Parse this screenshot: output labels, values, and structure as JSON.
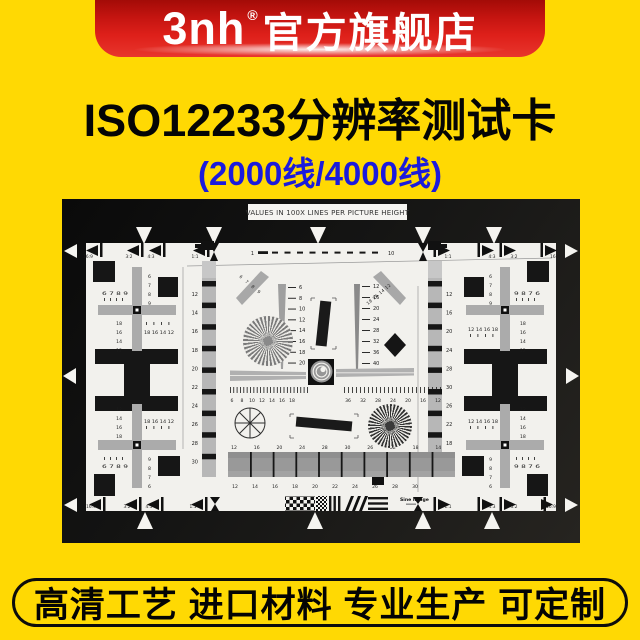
{
  "header": {
    "brand": "3nh",
    "registered": "®",
    "store": "官方旗舰店"
  },
  "title": "ISO12233分辨率测试卡",
  "subtitle": "(2000线/4000线)",
  "footer": "高清工艺 进口材料 专业生产 可定制",
  "colors": {
    "background_yellow": "#FFD903",
    "banner_red": "#DE201A",
    "subtitle_blue": "#1B1BDC",
    "chart_board_black": "#141414",
    "chart_paper_white": "#F2F1ED"
  },
  "chart": {
    "heading": "VALUES IN 100X LINES PER PICTURE HEIGHT",
    "maker": "Sine Image",
    "ruler_start": "1",
    "ruler_end": "10",
    "aspect_top_left": [
      "16:9",
      "3:2",
      "4:3",
      "1:1"
    ],
    "aspect_top_right": [
      "1:1",
      "4:3",
      "3:2",
      "16:9"
    ],
    "aspect_bottom_left": [
      "16:9",
      "3:2",
      "4:3",
      "1:1"
    ],
    "aspect_bottom_right": [
      "1:1",
      "4:3",
      "3:2",
      "16:9"
    ],
    "left_strip": [
      12,
      14,
      16,
      18,
      20,
      22,
      24,
      26,
      28,
      30
    ],
    "right_strip": [
      12,
      16,
      20,
      24,
      28,
      30,
      26,
      22,
      18,
      14
    ],
    "wedge_left": [
      6,
      8,
      10,
      12,
      14,
      16,
      18,
      20
    ],
    "wedge_right": [
      12,
      16,
      20,
      24,
      28,
      32,
      36,
      40
    ],
    "ruler_left": [
      6,
      8,
      10,
      12,
      14,
      16,
      18
    ],
    "ruler_right": [
      36,
      32,
      28,
      24,
      20,
      16,
      12
    ],
    "steps_top": [
      12,
      16,
      20,
      24,
      28,
      30,
      26,
      22,
      18,
      14
    ],
    "steps_bottom": [
      12,
      14,
      16,
      18,
      20,
      22,
      24,
      26,
      28,
      30
    ],
    "diag_left": [
      6,
      7,
      8,
      9
    ],
    "diag_right": [
      18,
      16,
      14,
      12
    ],
    "corner_tl": {
      "row": [
        6,
        7,
        8,
        9
      ],
      "stack": [
        6,
        7,
        8,
        9
      ],
      "beam_stack": [
        18,
        16,
        14,
        12
      ],
      "beam_row": [
        18,
        16,
        14,
        12
      ]
    },
    "corner_tr": {
      "row": [
        9,
        8,
        7,
        6
      ],
      "stack": [
        6,
        7,
        8,
        9
      ],
      "beam_stack": [
        18,
        16,
        14,
        12
      ],
      "beam_row": [
        12,
        14,
        16,
        18
      ]
    },
    "corner_bl": {
      "row": [
        6,
        7,
        8,
        9
      ],
      "stack": [
        9,
        8,
        7,
        6
      ],
      "beam_stack": [
        12,
        14,
        16,
        18
      ],
      "beam_row": [
        18,
        16,
        14,
        12
      ]
    },
    "corner_br": {
      "row": [
        9,
        8,
        7,
        6
      ],
      "stack": [
        9,
        8,
        7,
        6
      ],
      "beam_stack": [
        12,
        14,
        16,
        18
      ],
      "beam_row": [
        12,
        14,
        16,
        18
      ]
    }
  }
}
